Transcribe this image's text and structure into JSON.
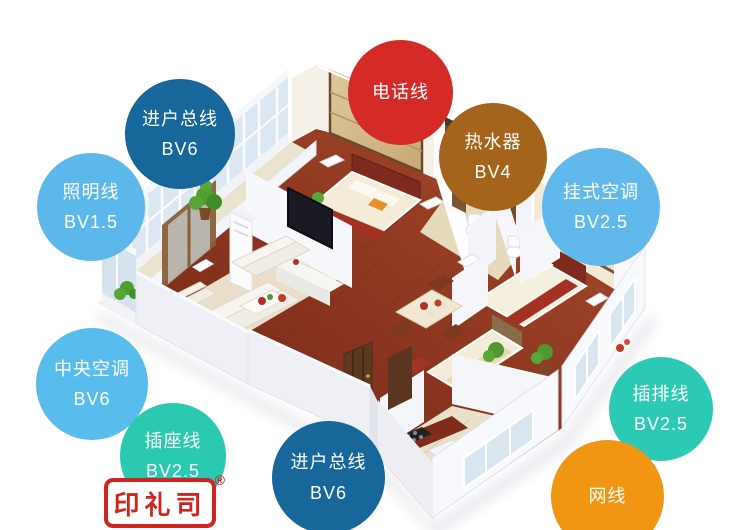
{
  "figure_title": "home wiring 3d floor plan infographic",
  "badges": [
    {
      "id": "incoming-main-line-top",
      "label": "进户总线",
      "spec": "BV6",
      "color": "#17679B"
    },
    {
      "id": "lighting-line",
      "label": "照明线",
      "spec": "BV1.5",
      "color": "#5CB8EB"
    },
    {
      "id": "telephone-line",
      "label": "电话线",
      "spec": "",
      "color": "#D42B27"
    },
    {
      "id": "water-heater",
      "label": "热水器",
      "spec": "BV4",
      "color": "#A4641C"
    },
    {
      "id": "wall-mounted-ac",
      "label": "挂式空调",
      "spec": "BV2.5",
      "color": "#60B9EA"
    },
    {
      "id": "central-ac",
      "label": "中央空调",
      "spec": "BV6",
      "color": "#58BCEC"
    },
    {
      "id": "socket-line",
      "label": "插座线",
      "spec": "BV2.5",
      "color": "#2CC9B1"
    },
    {
      "id": "incoming-main-line-bottom",
      "label": "进户总线",
      "spec": "BV6",
      "color": "#17679B"
    },
    {
      "id": "power-strip-line",
      "label": "插排线",
      "spec": "BV2.5",
      "color": "#2CC9B4"
    },
    {
      "id": "network-cable",
      "label": "网线",
      "spec": "",
      "color": "#F09613"
    }
  ],
  "stamp": {
    "text": "印礼司",
    "registered": "®",
    "color": "#D2241E"
  }
}
